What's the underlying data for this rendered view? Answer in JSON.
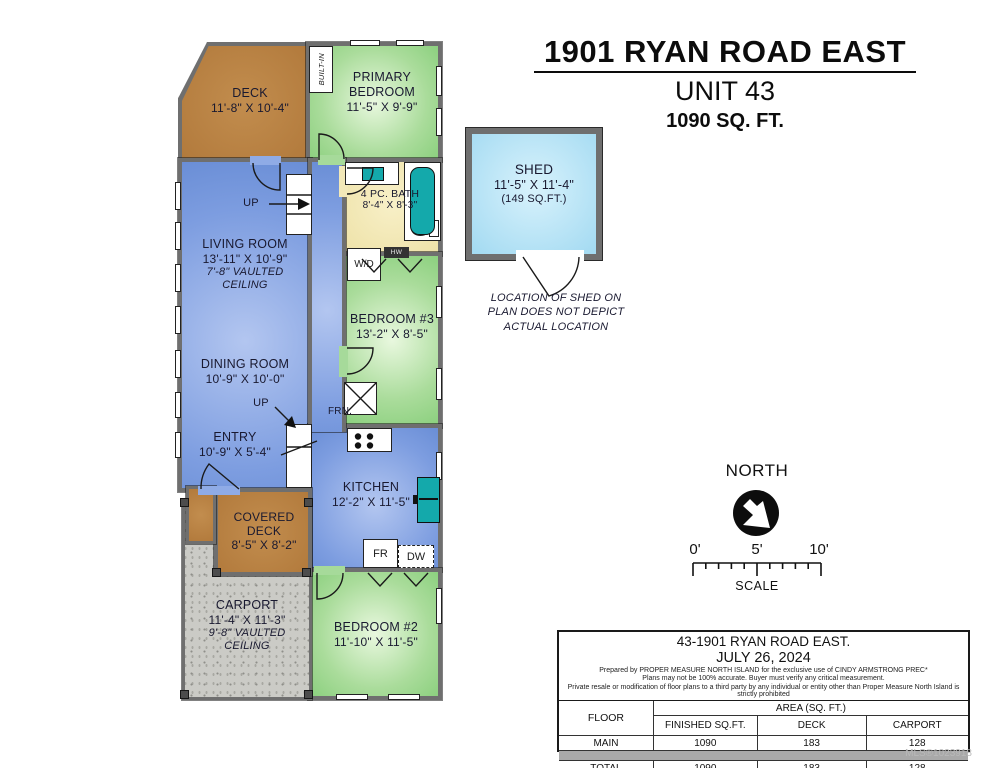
{
  "colors": {
    "wall": "#6f6f6f",
    "floor_blue": "#87a7e2",
    "room_green": "#9ad48d",
    "bath_yellow": "#f0e6b0",
    "deck_brown": "#b9803f",
    "carport_gray": "#cbcbc6",
    "shed_blue": "#b9e4f6",
    "fixture_teal": "#14a9ab"
  },
  "title": {
    "address": "1901 RYAN ROAD EAST",
    "unit": "UNIT 43",
    "area": "1090 SQ. FT."
  },
  "rooms": {
    "deck": {
      "name": "DECK",
      "dims": "11'-8\" X 10'-4\""
    },
    "primary_bedroom": {
      "name": "PRIMARY BEDROOM",
      "dims": "11'-5\" X 9'-9\""
    },
    "living_room": {
      "name": "LIVING ROOM",
      "dims": "13'-11\" X 10'-9\"",
      "note": "7'-8\" VAULTED CEILING"
    },
    "dining_room": {
      "name": "DINING ROOM",
      "dims": "10'-9\" X 10'-0\""
    },
    "entry": {
      "name": "ENTRY",
      "dims": "10'-9\" X 5'-4\""
    },
    "covered_deck": {
      "name": "COVERED DECK",
      "dims": "8'-5\" X 8'-2\""
    },
    "carport": {
      "name": "CARPORT",
      "dims": "11'-4\" X 11'-3\"",
      "note": "9'-8\" VAULTED CEILING"
    },
    "bath": {
      "name": "4 PC. BATH",
      "dims": "8'-4\" X 8'-3\""
    },
    "bedroom3": {
      "name": "BEDROOM #3",
      "dims": "13'-2\" X 8'-5\""
    },
    "kitchen": {
      "name": "KITCHEN",
      "dims": "12'-2\" X 11'-5\""
    },
    "bedroom2": {
      "name": "BEDROOM #2",
      "dims": "11'-10\" X 11'-5\""
    },
    "shed": {
      "name": "SHED",
      "dims": "11'-5\" X 11'-4\"",
      "area": "(149 SQ.FT.)",
      "note": "LOCATION OF SHED ON PLAN DOES NOT DEPICT ACTUAL LOCATION"
    }
  },
  "fixtures": {
    "built_in": "BUILT-IN",
    "washer_dryer": "W/D",
    "hot_water": "HW",
    "furnace": "FRN.",
    "fridge": "FR",
    "dishwasher": "DW",
    "up": "UP"
  },
  "compass": {
    "label": "NORTH"
  },
  "scale": {
    "tick0": "0'",
    "tick5": "5'",
    "tick10": "10'",
    "label": "SCALE"
  },
  "info_table": {
    "title": "43-1901 RYAN ROAD EAST.",
    "date": "JULY 26, 2024",
    "disclaimers": [
      "Prepared by PROPER MEASURE NORTH ISLAND for the exclusive use of CINDY ARMSTRONG PREC*",
      "Plans may not be 100% accurate.  Buyer must verify any critical measurement.",
      "Private resale  or modification of floor plans to a third party by any individual or entity other than Proper Measure North Island is strictly prohibited"
    ],
    "floor_header": "FLOOR",
    "area_header": "AREA (SQ. FT.)",
    "columns": [
      "FINISHED SQ.FT.",
      "DECK",
      "CARPORT"
    ],
    "rows": [
      {
        "floor": "MAIN",
        "values": [
          "1090",
          "183",
          "128"
        ]
      },
      {
        "floor": "TOTAL",
        "values": [
          "1090",
          "183",
          "128"
        ]
      }
    ]
  },
  "watermark": "MLS®1023918"
}
